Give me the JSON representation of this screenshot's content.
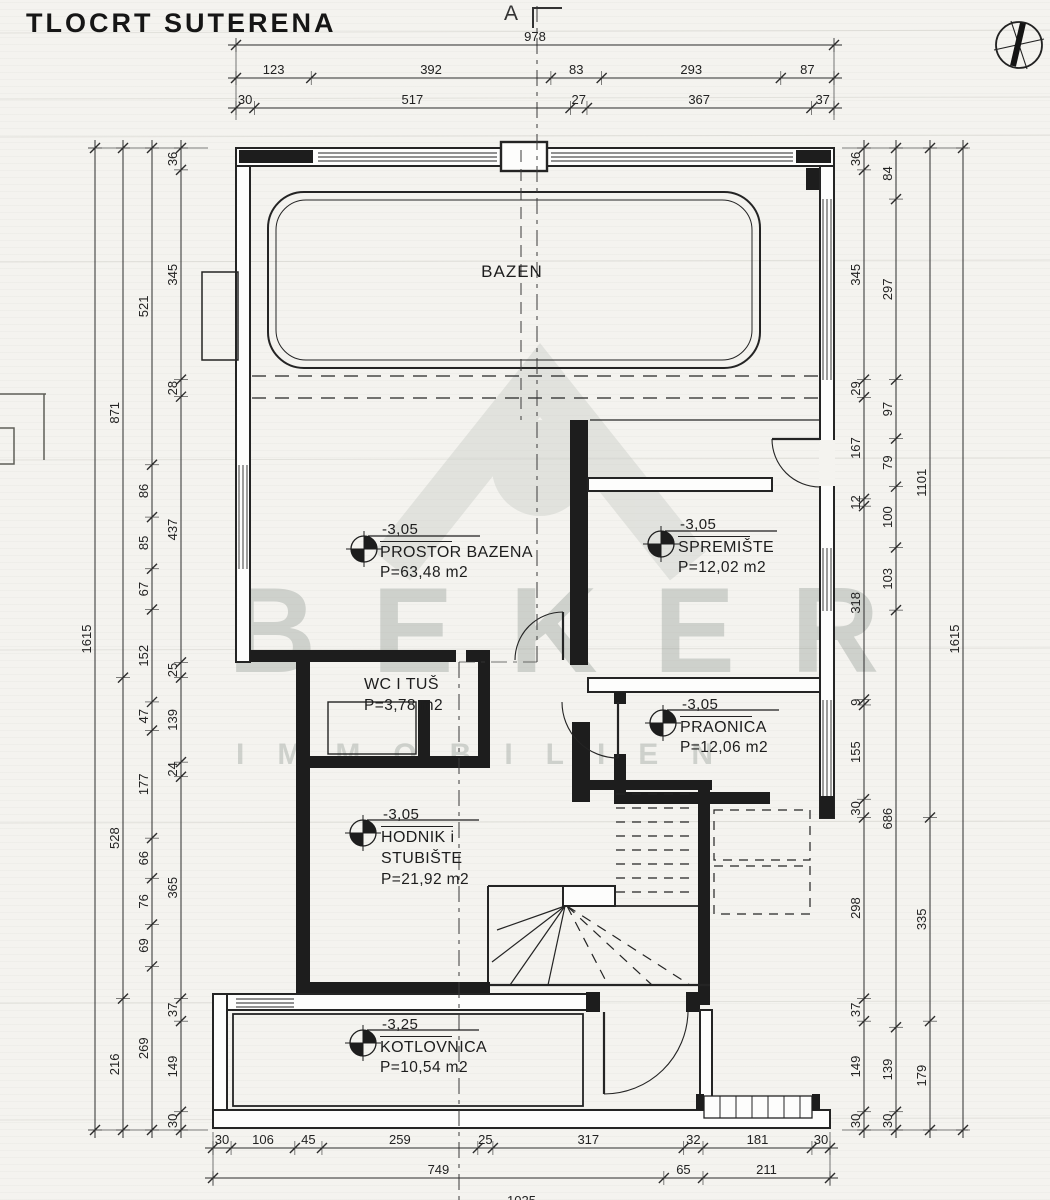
{
  "title": "TLOCRT SUTERENA",
  "section_marker": {
    "label": "A"
  },
  "icons": {
    "north_arrow": "north-arrow-compass",
    "level_marker": "elevation-level-marker"
  },
  "watermark": {
    "line1": "BEKER",
    "line2": "IMMOBILIEN"
  },
  "rooms": [
    {
      "id": "bazen",
      "name": "BAZEN"
    },
    {
      "id": "prostor-bazena",
      "name": "PROSTOR BAZENA",
      "area": "P=63,48 m2",
      "level": "-3,05"
    },
    {
      "id": "spremiste",
      "name": "SPREMIŠTE",
      "area": "P=12,02 m2",
      "level": "-3,05"
    },
    {
      "id": "wc-i-tus",
      "name": "WC I TUŠ",
      "area": "P=3,78 m2"
    },
    {
      "id": "praonica",
      "name": "PRAONICA",
      "area": "P=12,06 m2",
      "level": "-3,05"
    },
    {
      "id": "hodnik-i-stubiste",
      "name": "HODNIK i",
      "name2": "STUBIŠTE",
      "area": "P=21,92 m2",
      "level": "-3,05"
    },
    {
      "id": "kotlovnica",
      "name": "KOTLOVNICA",
      "area": "P=10,54 m2",
      "level": "-3,25"
    }
  ],
  "dimensions": {
    "chains": [
      {
        "id": "top-overall",
        "orient": "h",
        "pos": 45,
        "from": 236,
        "to": 834,
        "values": [
          978
        ]
      },
      {
        "id": "top-row2",
        "orient": "h",
        "pos": 78,
        "from": 236,
        "to": 834,
        "values": [
          123,
          392,
          83,
          293,
          87
        ]
      },
      {
        "id": "top-row3",
        "orient": "h",
        "pos": 108,
        "from": 236,
        "to": 834,
        "values": [
          30,
          517,
          27,
          367,
          37
        ]
      },
      {
        "id": "bottom-row1",
        "orient": "h",
        "pos": 1148,
        "from": 213,
        "to": 830,
        "values": [
          30,
          106,
          45,
          259,
          25,
          317,
          32,
          181,
          30
        ]
      },
      {
        "id": "bottom-row2",
        "orient": "h",
        "pos": 1178,
        "from": 213,
        "to": 830,
        "values": [
          749,
          65,
          211
        ]
      },
      {
        "id": "bottom-row3",
        "orient": "h",
        "pos": 1209,
        "from": 213,
        "to": 830,
        "values": [
          1025
        ]
      },
      {
        "id": "left-outer",
        "orient": "v",
        "pos": 95,
        "from": 148,
        "to": 1130,
        "values": [
          1615
        ]
      },
      {
        "id": "left-major",
        "orient": "v",
        "pos": 123,
        "from": 148,
        "to": 1130,
        "values": [
          871,
          528,
          216
        ]
      },
      {
        "id": "left-mid",
        "orient": "v",
        "pos": 152,
        "from": 148,
        "to": 1130,
        "values": [
          521,
          86,
          85,
          67,
          152,
          47,
          177,
          66,
          76,
          69,
          269
        ]
      },
      {
        "id": "left-inner",
        "orient": "v",
        "pos": 181,
        "from": 148,
        "to": 1130,
        "values": [
          36,
          345,
          28,
          437,
          25,
          139,
          24,
          365,
          37,
          149,
          30
        ]
      },
      {
        "id": "right-inner",
        "orient": "v",
        "pos": 864,
        "from": 148,
        "to": 1130,
        "values": [
          36,
          345,
          29,
          167,
          12,
          318,
          9,
          155,
          30,
          298,
          37,
          149,
          30
        ]
      },
      {
        "id": "right-mid",
        "orient": "v",
        "pos": 896,
        "from": 148,
        "to": 1130,
        "values": [
          84,
          297,
          97,
          79,
          100,
          103,
          686,
          139,
          30
        ]
      },
      {
        "id": "right-major",
        "orient": "v",
        "pos": 930,
        "from": 148,
        "to": 1130,
        "values": [
          1101,
          335,
          179
        ]
      },
      {
        "id": "right-outer",
        "orient": "v",
        "pos": 963,
        "from": 148,
        "to": 1130,
        "values": [
          1615
        ]
      }
    ]
  }
}
